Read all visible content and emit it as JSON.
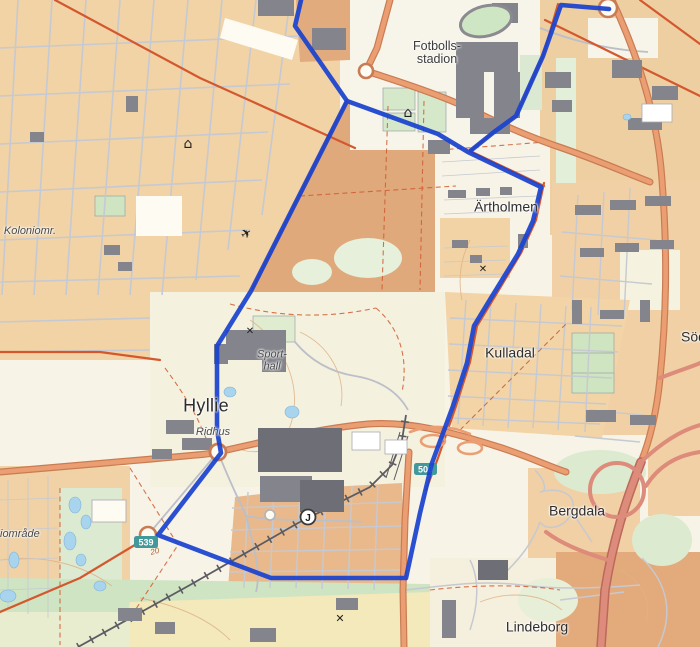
{
  "labels": {
    "fotbollsstadion_line1": "Fotbolls-",
    "fotbollsstadion_line2": "stadion",
    "artholmen": "Ärtholmen",
    "kulladal": "Kulladal",
    "hyllie": "Hyllie",
    "ridhus": "Ridhus",
    "sporthall_line1": "Sport-",
    "sporthall_line2": "hall",
    "koloniomr": "Koloniomr.",
    "koloniomrade_partial": "iområde",
    "sodertorp_partial": "Söd",
    "bergdala": "Bergdala",
    "lindeborg": "Lindeborg",
    "contour_20": "20"
  },
  "road_badges": {
    "badge_539": "539",
    "badge_500": "500"
  },
  "station": {
    "j_label": "J"
  },
  "icons": {
    "airplane": "✈",
    "house_1": "⌂",
    "house_2": "⌂",
    "windmill_1": "✕",
    "windmill_2": "✕",
    "windmill_3": "✕"
  },
  "colors": {
    "route_blue": "#1a43cf",
    "road_orange_fill": "#ea9e71",
    "road_orange_casing": "#c97c53",
    "road_thin_red": "#d4582e",
    "motorway_salmon": "#dd8b7b",
    "residential_tan": "#f1d3a6",
    "block_brown": "#dfa97c",
    "park_green": "#d6e8ca",
    "water_blue": "#a9d4ee",
    "field_yellow": "#f3e9bb",
    "building_gray": "#84858c",
    "street_gray": "#c6c9d1",
    "railway_gray": "#5b5b61",
    "badge_teal": "#42989a",
    "background_cream": "#f7f3e7"
  }
}
